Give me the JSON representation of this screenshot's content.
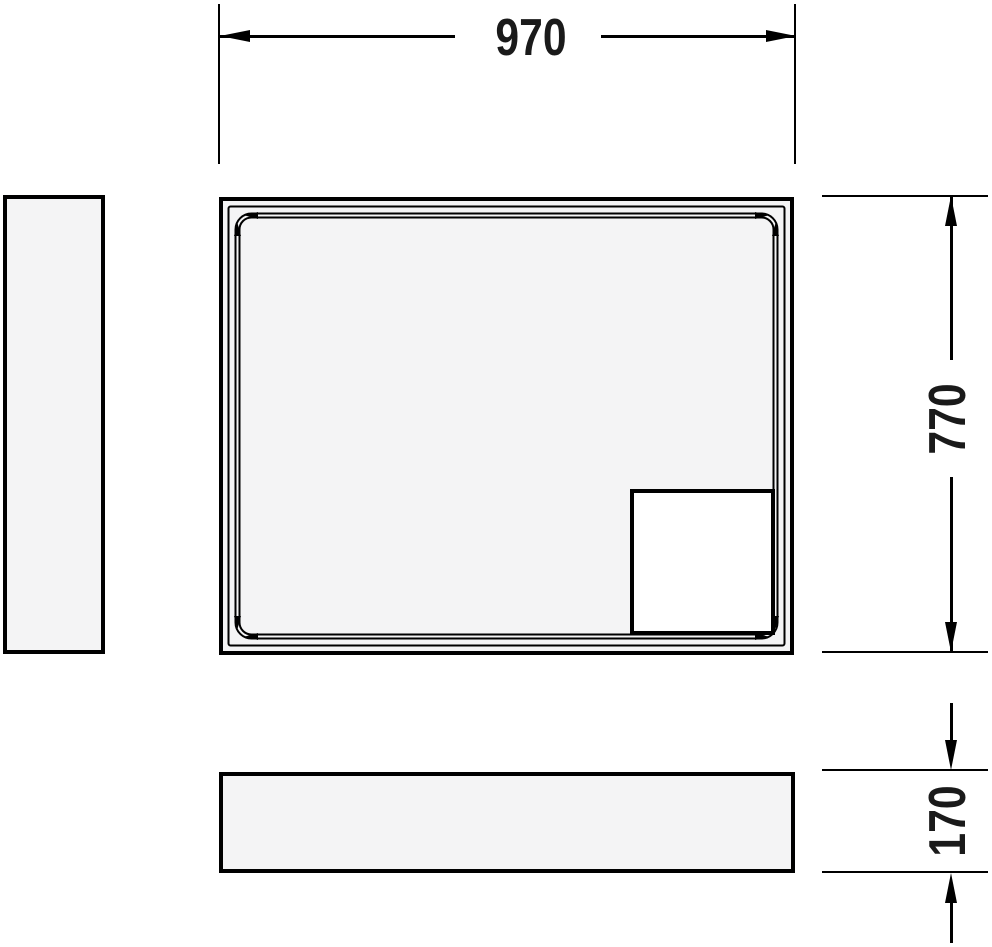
{
  "labels": {
    "width": "970",
    "depth": "770",
    "height": "170"
  },
  "colors": {
    "line": "#000000",
    "text": "#1a1a1a",
    "panel_fill": "#f4f4f5",
    "background": "#ffffff"
  }
}
